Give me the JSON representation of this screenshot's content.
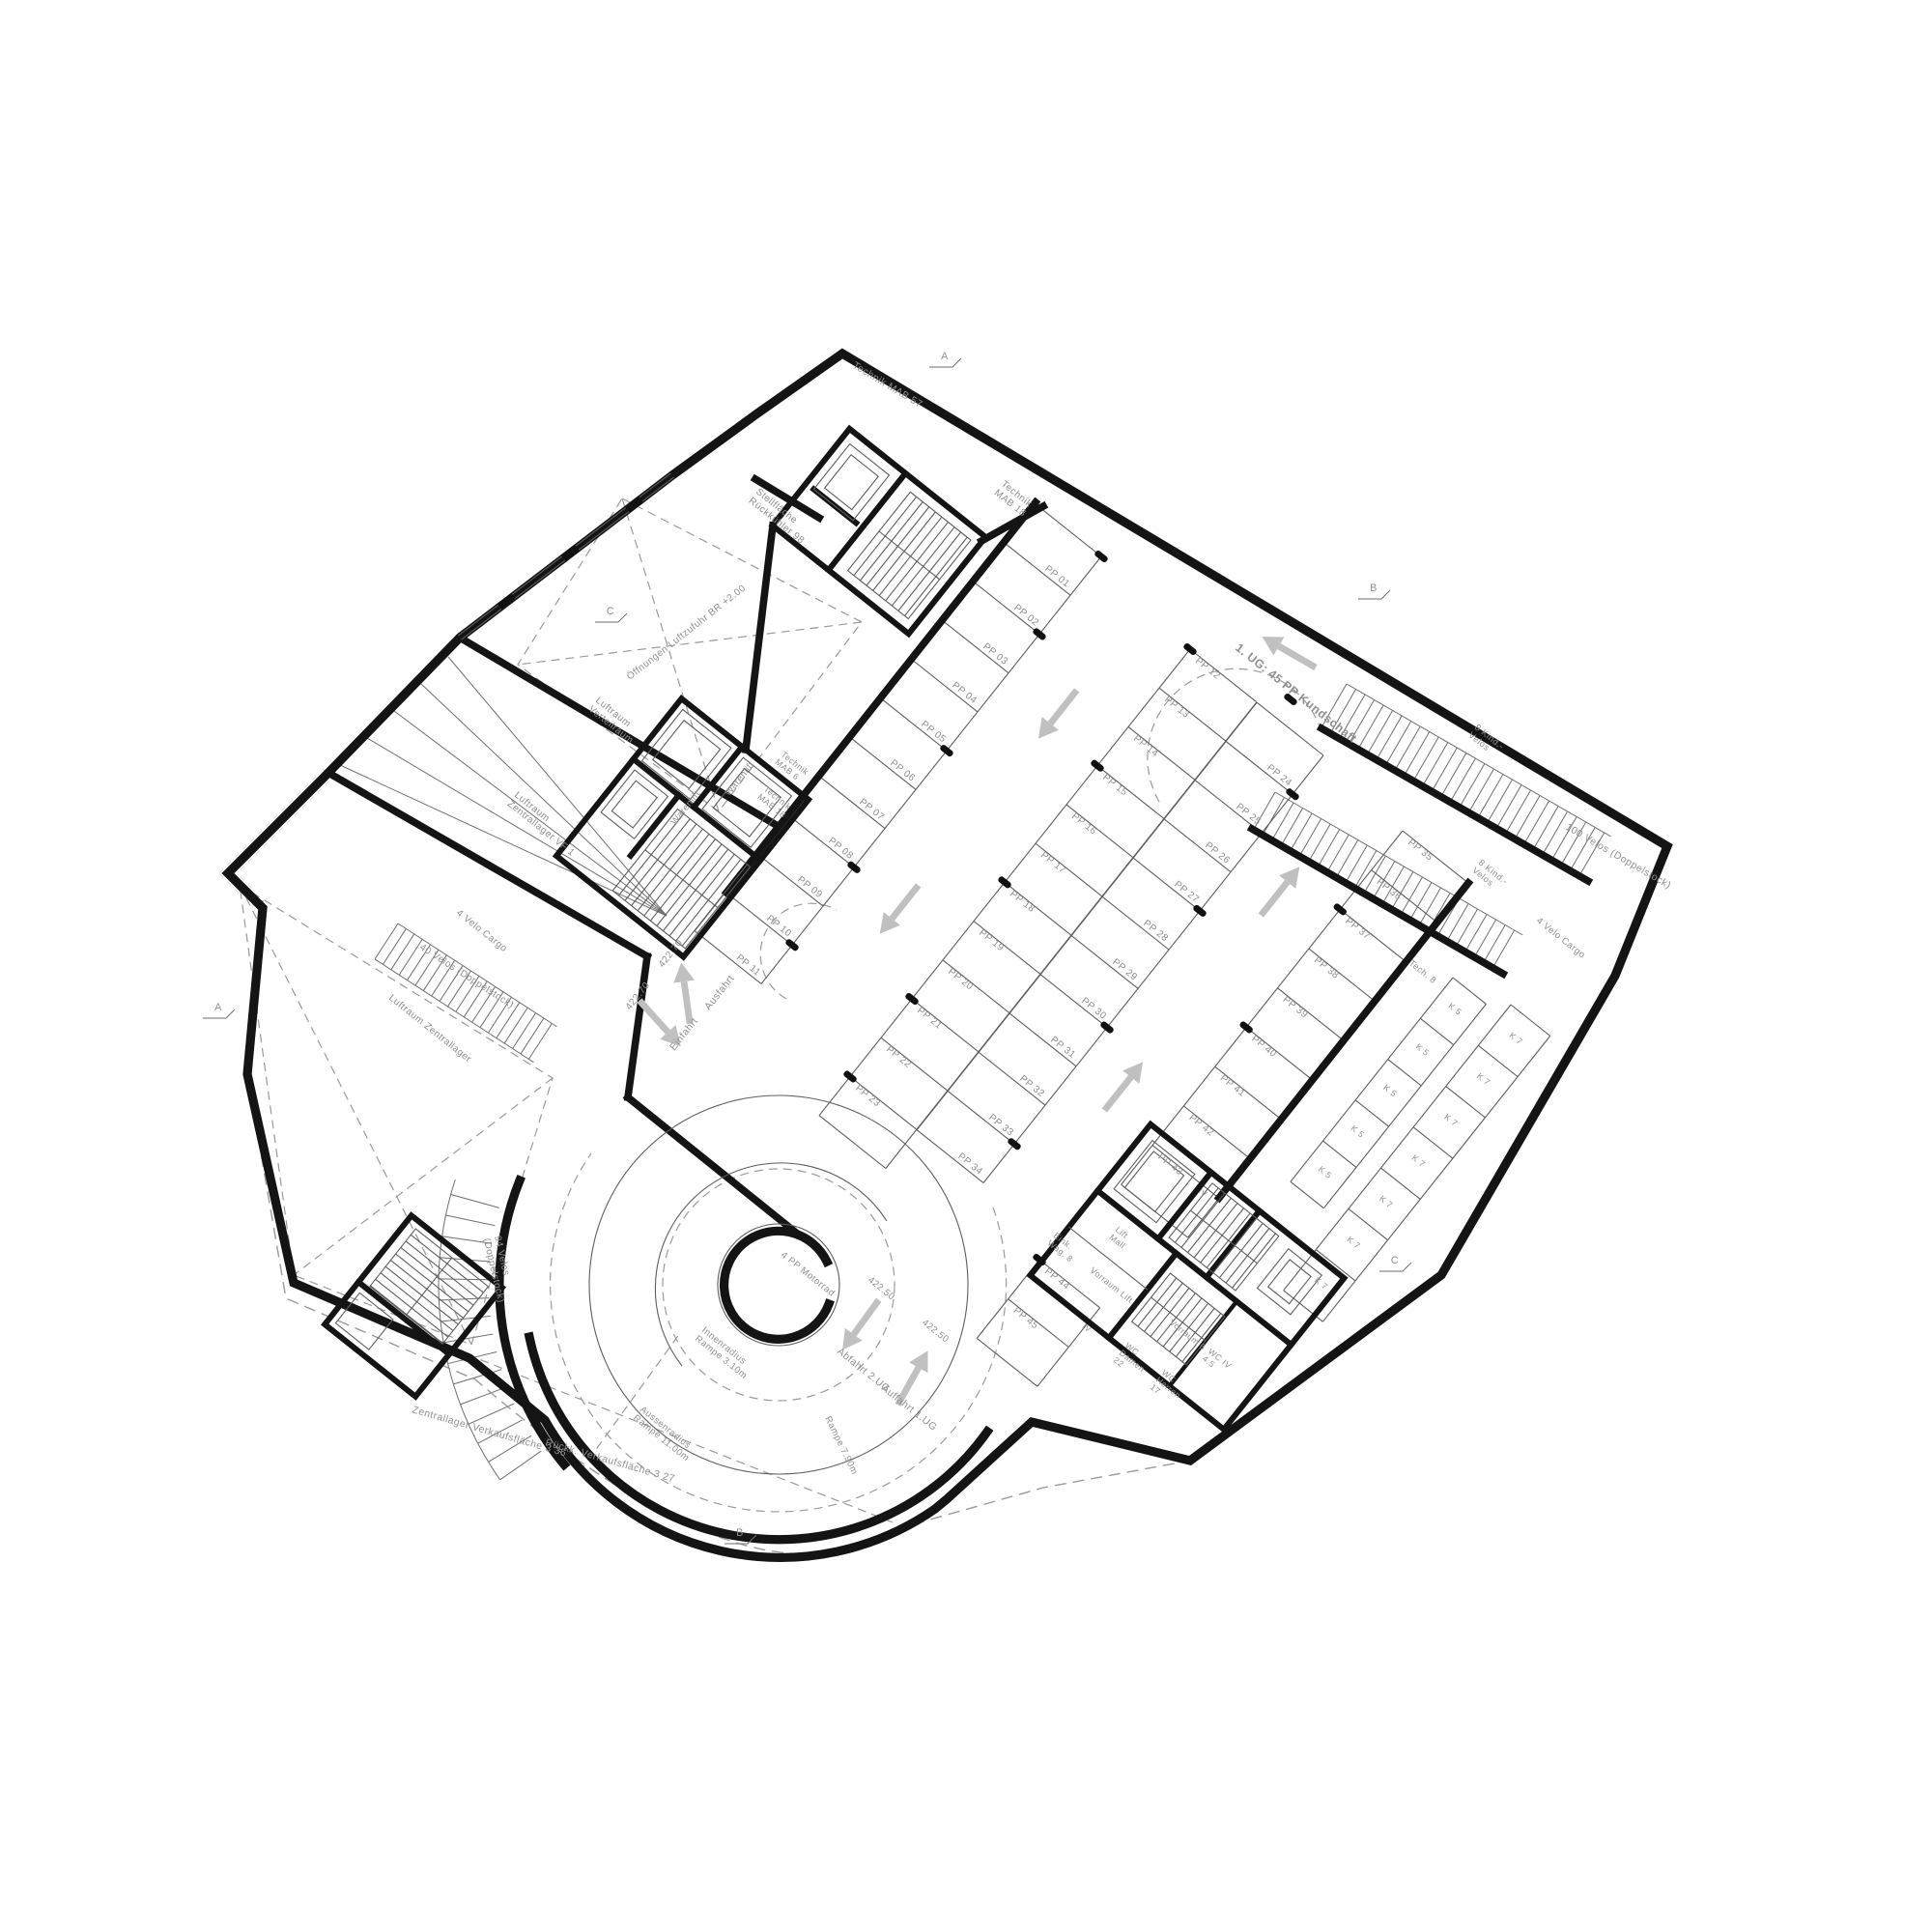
{
  "page": {
    "background": "#ffffff"
  },
  "colors": {
    "wall": "#141414",
    "thin_line": "#5d5d5d",
    "text": "#8f8f8f",
    "arrow": "#c0c0c0"
  },
  "icons": {
    "flow_arrow": "direction-arrow-icon",
    "column": "structural-column",
    "car_lift": "elevator",
    "stairs": "stair-flight"
  },
  "labels": {
    "technik_mab_57": "Technik MAB 57",
    "stellflaeche_rueckkuehler": [
      "Stellfläche",
      "Rückkühler 98"
    ],
    "oeffnungen_luftzufuhr": "Öffnungen Luftzufuhr  BR +2.00",
    "technik_mab_18_top": [
      "Technik",
      "MAB 18"
    ],
    "luftraum_verteilraum": [
      "Luftraum",
      "Verteilraum"
    ],
    "luftraum_zentrallager_vf1": [
      "Luftraum",
      "Zentrallager VF 1"
    ],
    "warenlift_1": "Warenlift",
    "warenlift_2": "Warenlift",
    "technik_mab_6": [
      "Technik",
      "MAB 6"
    ],
    "technik_mab_18_low": [
      "Technik",
      "MAB 18"
    ],
    "kundschaft": "1. UG:  45 PP Kundschaft",
    "velo_cargo_left": "4 Velo Cargo",
    "velos_40": "40 Velos (Doppelstock)",
    "luftraum_zentrallager": "Luftraum Zentrallager",
    "velos_94": [
      "94 Velos",
      "(Doppelstock)"
    ],
    "einfahrt": "Einfahrt",
    "ausfahrt": "Ausfahrt",
    "zentrallager_vf": "Zentrallager Verkaufsfläche 3   36",
    "rueckk_vf": "Rückk. Verkaufsfläche 3   27",
    "motorrad": "4 PP Motorrad",
    "innenradius": [
      "Innenradius",
      "Rampe 3.10m"
    ],
    "aussenradius": [
      "Aussenradius",
      "Rampe 11.00m"
    ],
    "rampe_79": "Rampe 7.90m",
    "abfahrt": "Abfahrt 2.UG",
    "auffahrt": "Auffahrt 1.UG",
    "kind_velos_a": [
      "8 Kind.-",
      "Velos"
    ],
    "kind_velos_b": [
      "8 Kind.-",
      "Velos"
    ],
    "velos_100": "100 Velos (Doppelstock)",
    "velo_cargo_right": "4 Velo Cargo",
    "tech_8": "Tech. 8",
    "eink_wag": [
      "Eink.",
      "Wag. 8"
    ],
    "lift_mall": [
      "Lift",
      "Mall"
    ],
    "vorraum_lift": "Vorraum Lift",
    "vorraum_6": "Vorraum 6",
    "wc_damen": [
      "WC",
      "Damen",
      "22"
    ],
    "wc_herren": [
      "WC",
      "Herren",
      "17"
    ],
    "wc_iv": [
      "WC IV",
      "4.5"
    ],
    "iv_a": "IV",
    "iv_b": "IV"
  },
  "elevations": {
    "e422_70_a": "422.70",
    "e422_70_b": "422.70",
    "e422_50_a": "422.50",
    "e422_50_b": "422.50"
  },
  "parking": {
    "total_note": "1. UG:  45 PP Kundschaft",
    "rows": {
      "row_a": [
        "PP 01",
        "PP 02",
        "PP 03",
        "PP 04",
        "PP 05",
        "PP 06",
        "PP 07",
        "PP 08",
        "PP 09",
        "PP 10",
        "PP 11"
      ],
      "mid_left": [
        "PP 12",
        "PP 13",
        "PP 14",
        "PP 15",
        "PP 16",
        "PP 17",
        "PP 18",
        "PP 19",
        "PP 20",
        "PP 21",
        "PP 22",
        "PP 23"
      ],
      "mid_right": [
        "PP 24",
        "PP 25",
        "PP 26",
        "PP 27",
        "PP 28",
        "PP 29",
        "PP 30",
        "PP 31",
        "PP 32",
        "PP 33",
        "PP 34"
      ],
      "right_col": [
        "PP 35",
        "PP 36",
        "PP 37",
        "PP 38",
        "PP 39",
        "PP 40",
        "PP 41",
        "PP 42",
        "PP 43"
      ],
      "bottom": [
        "PP 44",
        "PP 45"
      ]
    }
  },
  "storage": {
    "k5_cells": [
      "K 5",
      "K 5",
      "K 5",
      "K 5",
      "K 5"
    ],
    "k7_cells": [
      "K 7",
      "K 7",
      "K 7",
      "K 7",
      "K 7",
      "K 7",
      "K 7"
    ]
  },
  "section_markers": [
    "A",
    "B",
    "C",
    "C",
    "B",
    "A"
  ]
}
